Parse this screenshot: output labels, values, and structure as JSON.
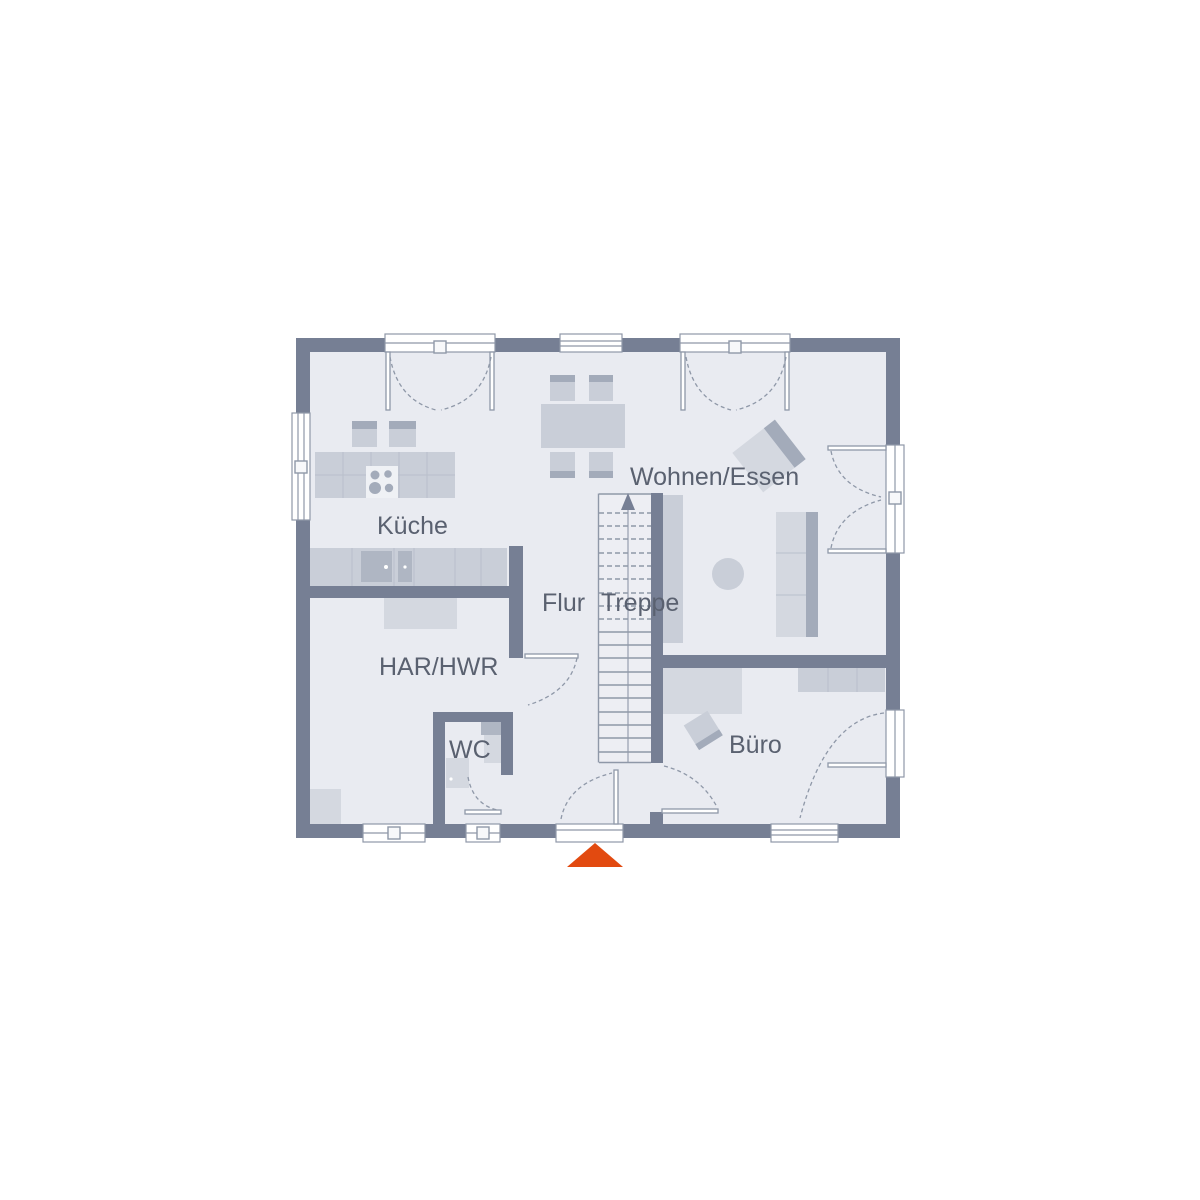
{
  "floor_plan": {
    "rooms": [
      {
        "id": "kueche",
        "label": "Küche"
      },
      {
        "id": "wohnen-essen",
        "label": "Wohnen/Essen"
      },
      {
        "id": "flur",
        "label": "Flur"
      },
      {
        "id": "treppe",
        "label": "Treppe"
      },
      {
        "id": "har-hwr",
        "label": "HAR/HWR"
      },
      {
        "id": "wc",
        "label": "WC"
      },
      {
        "id": "buero",
        "label": "Büro"
      }
    ],
    "stairs": {
      "direction": "up"
    },
    "entrance_marker": {
      "shape": "triangle"
    },
    "colors": {
      "wall": "#767F94",
      "floor": "#E9EBF1",
      "stair_floor": "#EDEEF3",
      "furniture_light": "#D4D8E0",
      "furniture_mid": "#C9CED8",
      "furniture_dark": "#A3ABBA",
      "furniture_deep": "#AFB6C3",
      "line": "#8F98A8",
      "text": "#5A6170",
      "accent": "#E24A10",
      "background": "#FFFFFF"
    }
  }
}
